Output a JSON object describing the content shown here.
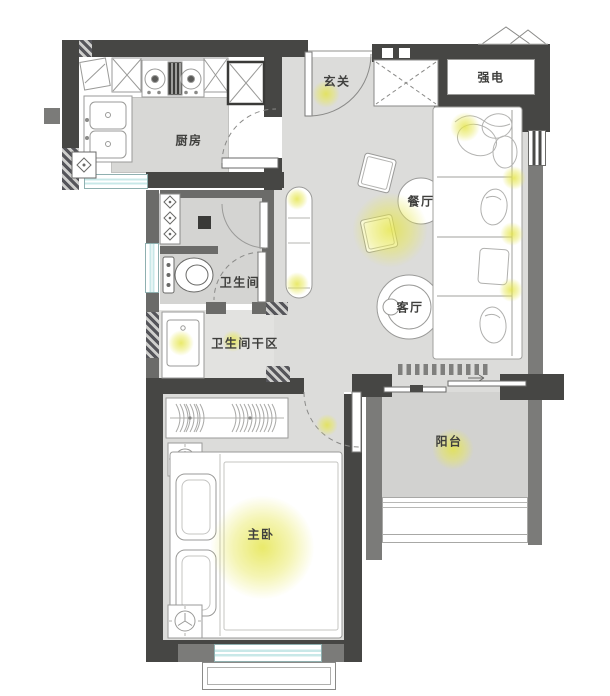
{
  "floorplan": {
    "labels": {
      "entrance": "玄关",
      "electric_box": "强电",
      "kitchen": "厨房",
      "dining": "餐厅",
      "living": "客厅",
      "bathroom": "卫生间",
      "bathroom_dry": "卫生间干区",
      "master_bedroom": "主卧",
      "balcony": "阳台"
    },
    "colors": {
      "wall_dark": "#464644",
      "wall_gray": "#7b7b79",
      "floor_gray": "#dcdcda",
      "window_glass": "#c8e8e8",
      "light_glow": "#e6e650"
    }
  }
}
